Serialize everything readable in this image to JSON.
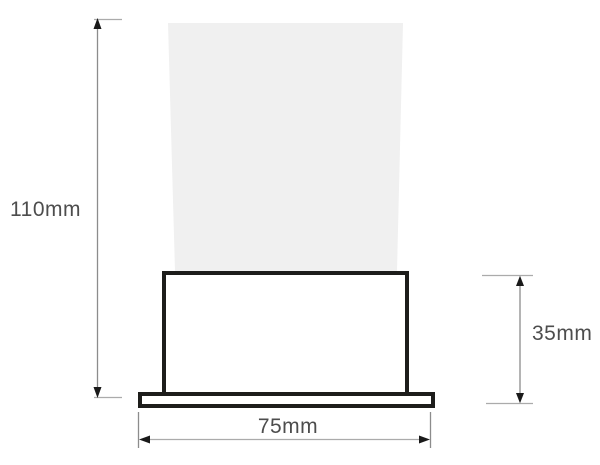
{
  "diagram": {
    "kind": "technical-dimension-drawing",
    "labels": {
      "overall_height": "110mm",
      "body_height": "35mm",
      "base_width": "75mm"
    },
    "dimensions": [
      {
        "name": "overall-height",
        "label": "110mm",
        "orientation": "vertical",
        "position": "left"
      },
      {
        "name": "body-height",
        "label": "35mm",
        "orientation": "vertical",
        "position": "right"
      },
      {
        "name": "base-width",
        "label": "75mm",
        "orientation": "horizontal",
        "position": "bottom"
      }
    ],
    "colors": {
      "background": "#ffffff",
      "beam_fill": "#f0f0f0",
      "fixture_outline": "#1d1d1b",
      "dimension_line": "#8c8c8c",
      "extension_tick": "#ababab",
      "arrow": "#1a1a1a",
      "label_text": "#4d4d4d"
    }
  }
}
